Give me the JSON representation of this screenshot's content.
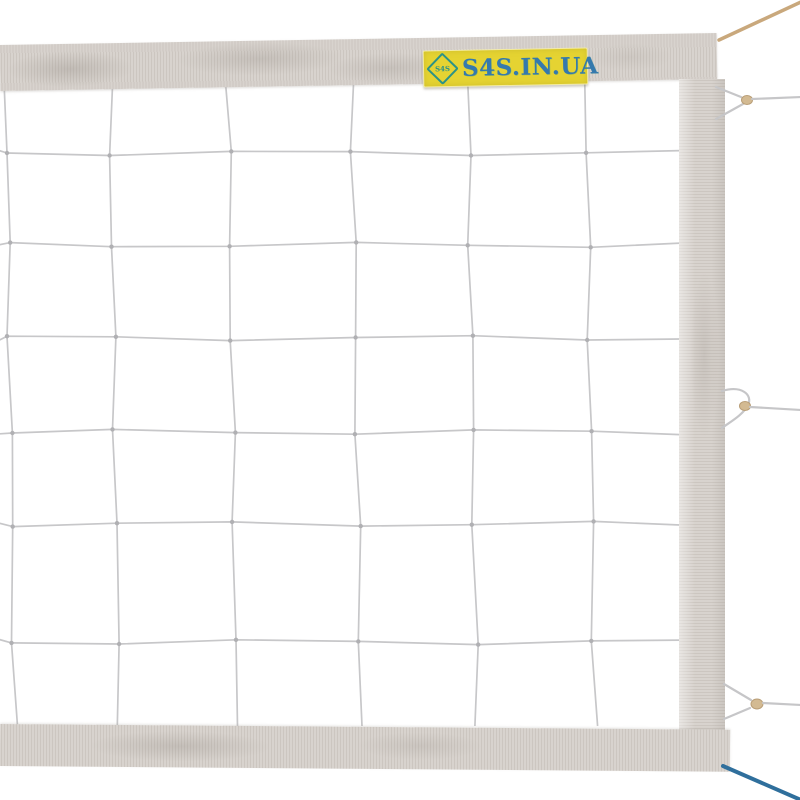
{
  "scene": {
    "subject": "white volleyball net with fabric edge tapes, brand label and tension cords",
    "background_color": "#ffffff"
  },
  "brand_label": {
    "text": "S4S.IN.UA",
    "logo_text": "S4S",
    "background_color": "#e5d332",
    "text_color": "#3579ad",
    "logo_color": "#2c9287"
  },
  "net": {
    "band_color": "#d8d3ce",
    "band_rib_color": "#ccc6c0",
    "cord_color": "#c7c7c9",
    "knot_color": "#b0b0b3",
    "mesh_columns_x": [
      6,
      110,
      228,
      352,
      468,
      586
    ],
    "mesh_rows_y": [
      153,
      245,
      338,
      432,
      524,
      642
    ],
    "net_top_y": 84,
    "net_bottom_y": 726,
    "net_right_x": 680,
    "mesh_column_count": 6,
    "mesh_row_count": 6
  },
  "rigging": {
    "top_cord": {
      "name": "tan-tension-cord",
      "color": "#c9a87c"
    },
    "bottom_cord": {
      "name": "blue-tension-cord",
      "color": "#2f6f9c"
    },
    "side_loops": {
      "count": 3,
      "bead_color": "#d3ba92",
      "string_color": "#c6c6c8"
    }
  }
}
